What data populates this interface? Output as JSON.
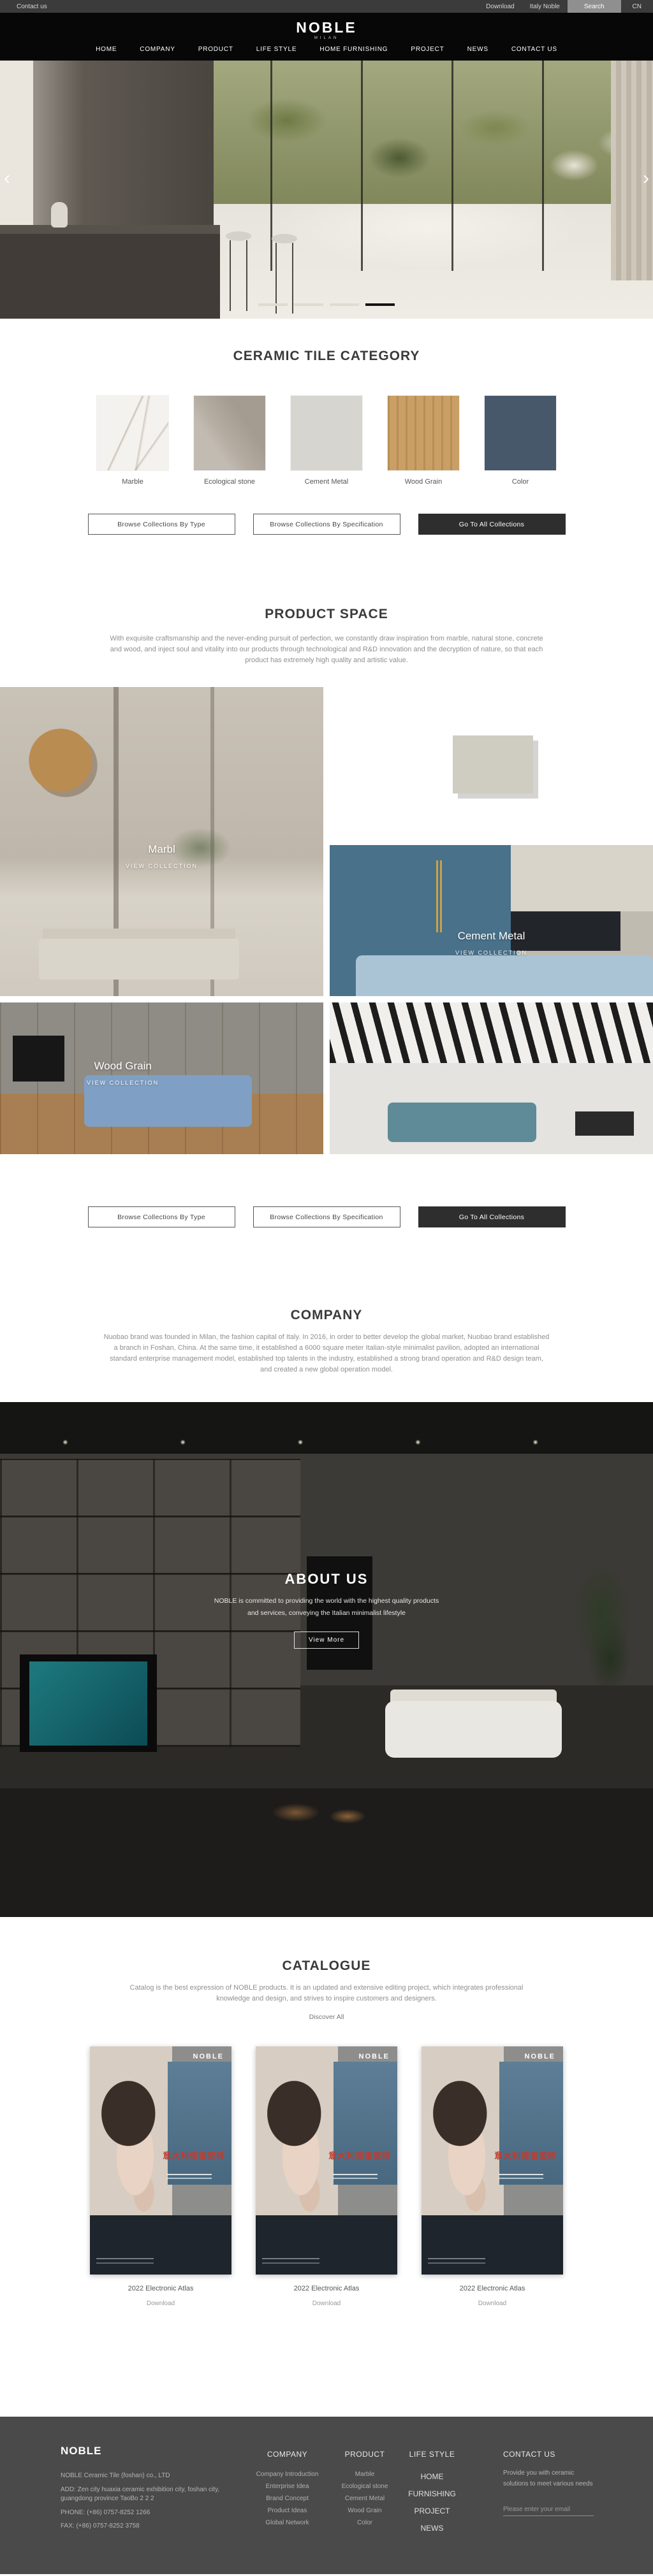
{
  "topbar": {
    "contact": "Contact us",
    "download": "Download",
    "italy_noble": "Italy Noble",
    "search": "Search",
    "lang": "CN"
  },
  "header": {
    "logo": "NOBLE",
    "logo_sub": "MILAN",
    "nav": [
      "HOME",
      "COMPANY",
      "PRODUCT",
      "LIFE STYLE",
      "HOME FURNISHING",
      "PROJECT",
      "NEWS",
      "CONTACT US"
    ]
  },
  "hero": {
    "prev_icon": "‹",
    "next_icon": "›",
    "slides_total": 4,
    "active_slide": 4
  },
  "category": {
    "title": "CERAMIC TILE CATEGORY",
    "items": [
      {
        "label": "Marble",
        "color": "#f4f2ee"
      },
      {
        "label": "Ecological stone",
        "color": "#b4aca1"
      },
      {
        "label": "Cement Metal",
        "color": "#d7d5d0"
      },
      {
        "label": "Wood Grain",
        "color": "#c99f66"
      },
      {
        "label": "Color",
        "color": "#46586a"
      }
    ]
  },
  "collection_buttons": {
    "by_type": "Browse Collections By Type",
    "by_spec": "Browse Collections By Specification",
    "go_all": "Go To All Collections"
  },
  "product_space": {
    "title": "PRODUCT SPACE",
    "description": "With exquisite craftsmanship and the never-ending pursuit of perfection, we constantly draw inspiration from marble, natural stone, concrete and wood, and inject soul and vitality into our products through technological and R&D innovation and the decryption of nature, so that each product has extremely high quality and artistic value.",
    "overlays": [
      {
        "name": "Marbl",
        "cta": "VIEW COLLECTION"
      },
      {
        "name": "Cement Metal",
        "cta": "VIEW COLLECTION"
      },
      {
        "name": "Wood Grain",
        "cta": "VIEW COLLECTION"
      }
    ]
  },
  "company": {
    "title": "COMPANY",
    "description": "Nuobao brand was founded in Milan, the fashion capital of Italy. In 2016, in order to better develop the global market, Nuobao brand established a branch in Foshan, China. At the same time, it established a 6000 square meter Italian-style minimalist pavilion, adopted an international standard enterprise management model, established top talents in the industry, established a strong brand operation and R&D design team, and created a new global operation model."
  },
  "about": {
    "title": "ABOUT US",
    "line1": "NOBLE is committed to providing the world with the highest quality products",
    "line2": "and services, conveying the Italian minimalist lifestyle",
    "button": "View More"
  },
  "catalogue": {
    "title": "CATALOGUE",
    "description": "Catalog is the best expression of NOBLE products. It is an updated and extensive editing project, which integrates professional knowledge and design, and strives to inspire customers and designers.",
    "discover": "Discover All",
    "cover_brand": "NOBLE",
    "cover_title": "意大利诺宝瓷砖",
    "items": [
      {
        "title": "2022 Electronic Atlas",
        "download": "Download"
      },
      {
        "title": "2022 Electronic Atlas",
        "download": "Download"
      },
      {
        "title": "2022 Electronic Atlas",
        "download": "Download"
      }
    ]
  },
  "footer": {
    "brand": "NOBLE",
    "company_name": "NOBLE Ceramic Tile (foshan) co., LTD",
    "address": "ADD:  Zen city huaxia ceramic exhibition city, foshan city, guangdong province TaoBo 2 2 2",
    "phone": "PHONE:   (+86)  0757-8252 1266",
    "fax": "FAX:   (+86)  0757-8252 3758",
    "col_company": {
      "title": "COMPANY",
      "items": [
        "Company Introduction",
        "Enterprise Idea",
        "Brand Concept",
        "Product Ideas",
        "Global Network"
      ]
    },
    "col_product": {
      "title": "PRODUCT",
      "items": [
        "Marble",
        "Ecological stone",
        "Cement Metal",
        "Wood Grain",
        "Color"
      ]
    },
    "col_explore": {
      "title": "LIFE STYLE",
      "items": [
        "HOME FURNISHING",
        "PROJECT",
        "NEWS"
      ]
    },
    "col_contact": {
      "title": "CONTACT US",
      "text": "Provide you with ceramic solutions to meet various needs",
      "email_placeholder": "Please enter your email"
    }
  }
}
